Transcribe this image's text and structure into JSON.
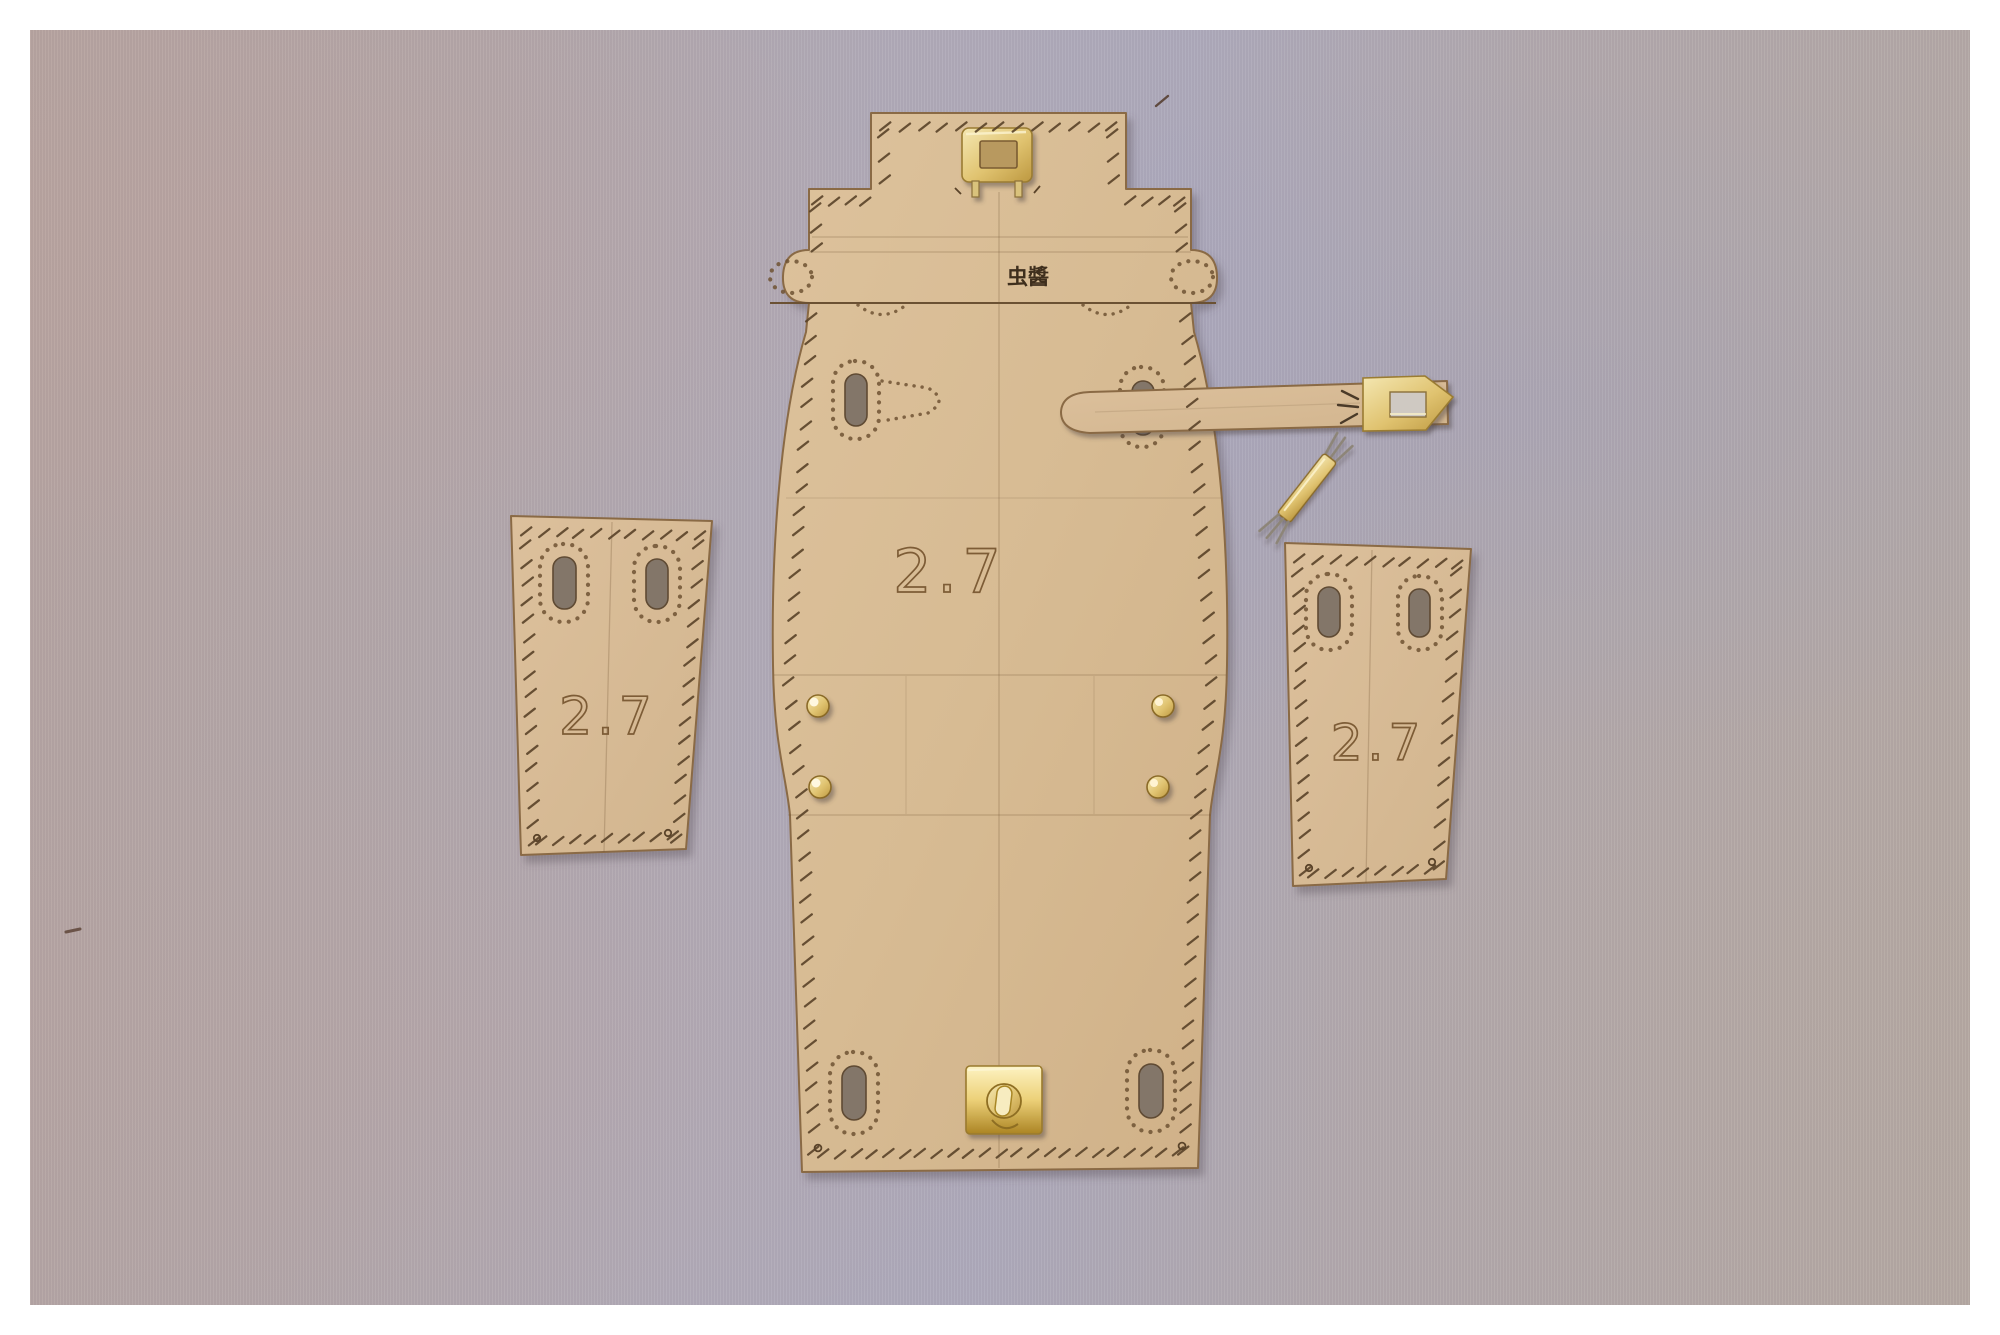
{
  "scene": {
    "description": "Flat-lay photograph of a laser-cut leathercraft handbag template kit (kraft board patterns) with brass hardware arranged on a mauve fabric background"
  },
  "templates": {
    "main_body": {
      "size_label": "2.7",
      "brand_stamp": "虫醬"
    },
    "left_gusset": {
      "size_label": "2.7"
    },
    "right_gusset": {
      "size_label": "2.7"
    },
    "strap": {
      "name": "strap-template"
    }
  },
  "hardware": {
    "top_keeper": "brass-rectangular-keeper",
    "turn_lock": "brass-turn-lock",
    "strap_tip": "brass-strap-tip-plate",
    "pronged_bar": "brass-pronged-bar",
    "rivets": "brass-dome-rivets-x4"
  },
  "colors": {
    "photo_border": "#ffffff",
    "background_fabric": "#b2a7ab",
    "board": "#d8bc95",
    "board_edge": "#8a6a45",
    "engraving": "#7d5c36",
    "brass": "#e4cf8f",
    "brass_bright": "#f3df96"
  }
}
